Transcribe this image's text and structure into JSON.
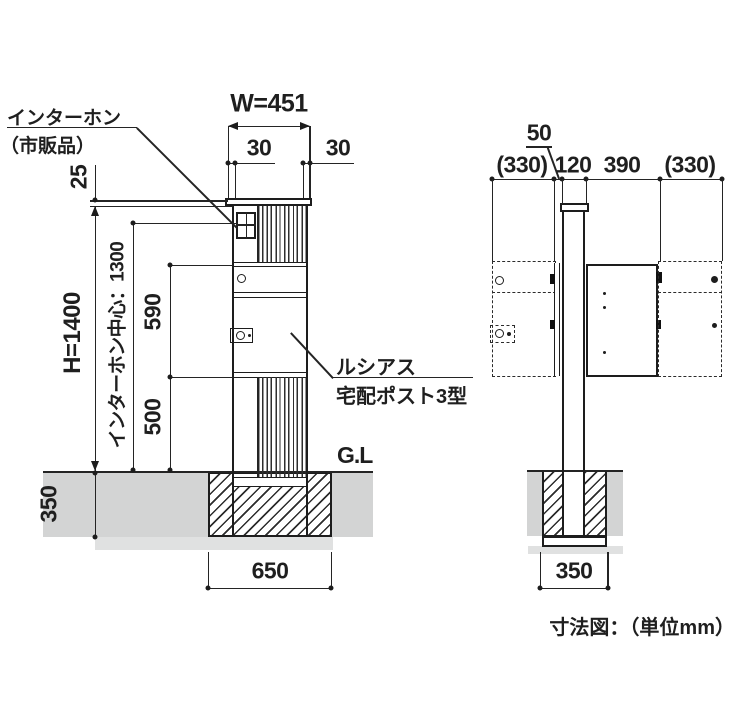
{
  "caption": "寸法図：（単位mm）",
  "colors": {
    "line": "#1d1d1d",
    "ground": "#d3d4d4",
    "substrate": "#e0e1e1",
    "background": "#ffffff"
  },
  "front": {
    "callout_intercom": {
      "line1": "インターホン",
      "line2": "（市販品）"
    },
    "callout_product": {
      "line1": "ルシアス",
      "line2": "宅配ポスト3型"
    },
    "ground_label": "G.L",
    "dims": {
      "width": "W=451",
      "overhang_left": "30",
      "overhang_right": "30",
      "cap_height": "25",
      "total_height": "H=1400",
      "intercom_center": "インターホン中心：1300",
      "upper_section": "590",
      "lower_section": "500",
      "embed_depth": "350",
      "footing_width": "650"
    }
  },
  "side": {
    "dims": {
      "gap": "50",
      "door_swing_left": "(330)",
      "post_depth": "120",
      "box_depth": "390",
      "door_swing_right": "(330)",
      "footing_width": "350"
    }
  }
}
